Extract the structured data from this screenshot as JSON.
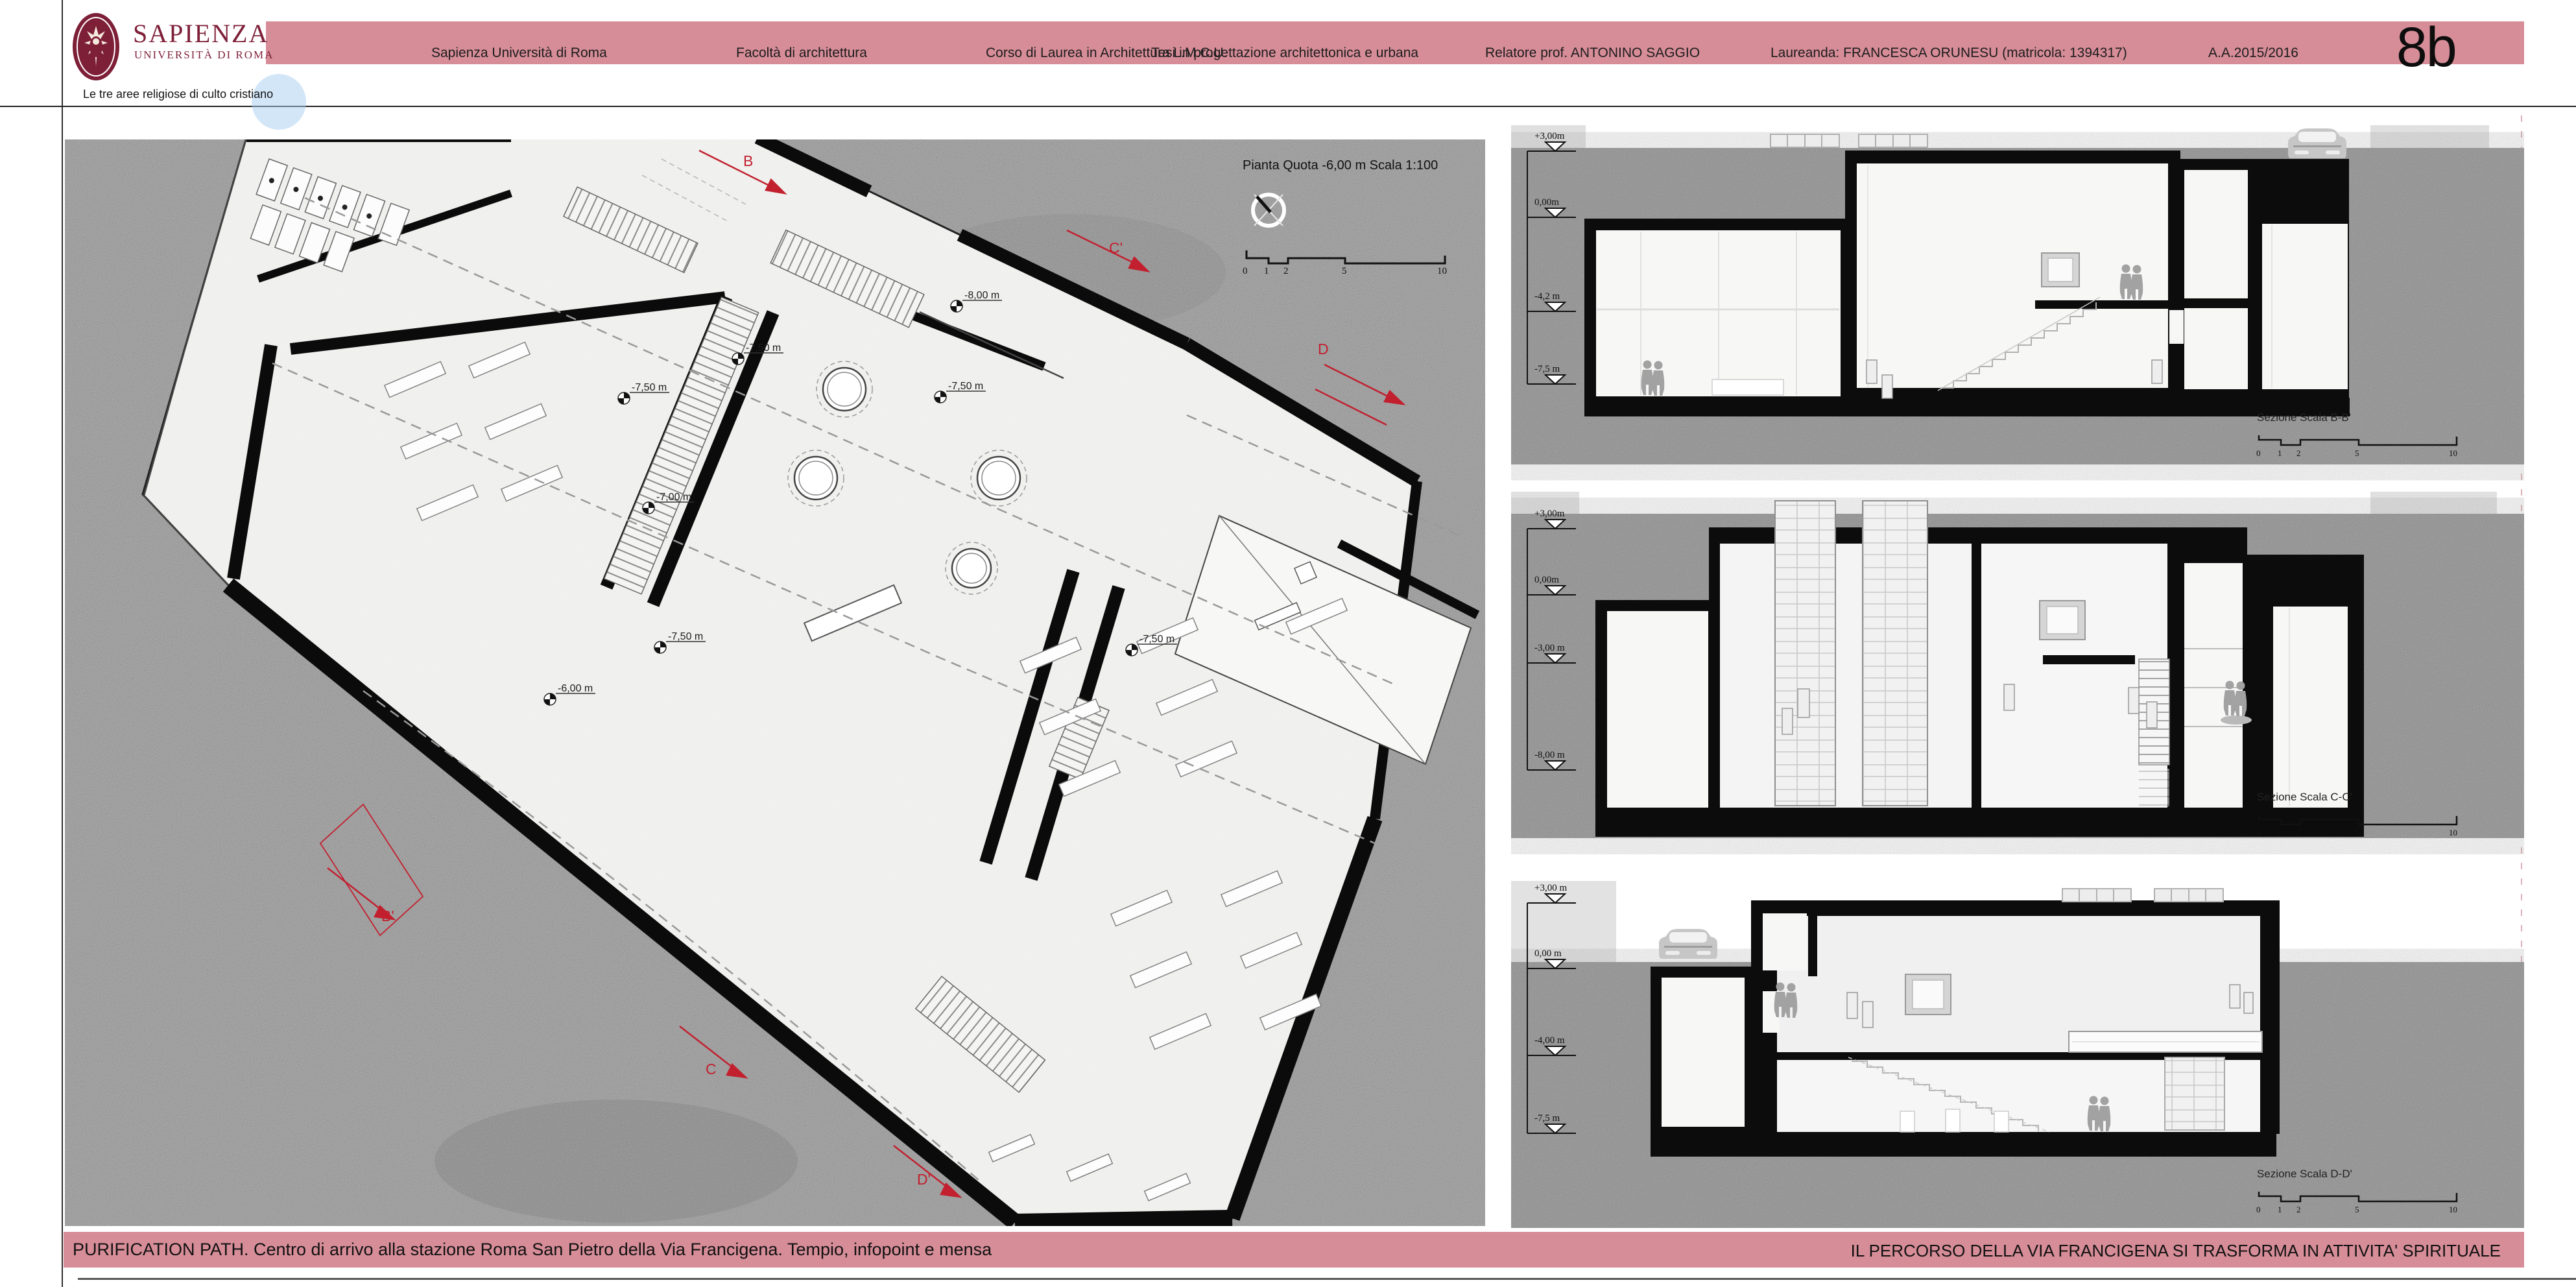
{
  "header": {
    "brand": {
      "name": "SAPIENZA",
      "subtitle": "UNIVERSITÀ DI ROMA"
    },
    "items": [
      {
        "label": "Sapienza Università di Roma"
      },
      {
        "label": "Facoltà di architettura"
      },
      {
        "label": "Corso di Laurea in Architettura L.M.C.U."
      },
      {
        "label": "Tesi in progettazione architettonica e urbana"
      },
      {
        "label": "Relatore prof. ANTONINO SAGGIO"
      },
      {
        "label": "Laureanda: FRANCESCA ORUNESU (matricola: 1394317)"
      },
      {
        "label": "A.A.2015/2016"
      }
    ],
    "page_number": "8b"
  },
  "subtitle": "Le tre aree religiose di culto cristiano",
  "plan": {
    "title": "Pianta Quota -6,00 m Scala 1:100",
    "levels": [
      "-8,00 m",
      "-7,50 m",
      "-7,50 m",
      "-7,50 m",
      "-7,00 m",
      "-7,50 m",
      "-7,50 m",
      "-6,00 m"
    ],
    "cuts": [
      "B",
      "C'",
      "D",
      "B'",
      "C",
      "D'"
    ]
  },
  "scalebar": {
    "ticks": [
      "0",
      "1",
      "2",
      "5",
      "10"
    ]
  },
  "sections": [
    {
      "label": "Sezione Scala B-B'",
      "elevations": [
        "+3,00m",
        "0,00m",
        "-4,2 m",
        "-7,5 m"
      ]
    },
    {
      "label": "Sezione Scala C-C'",
      "elevations": [
        "+3,00m",
        "0,00m",
        "-3,00 m",
        "-8,00 m"
      ]
    },
    {
      "label": "Sezione Scala D-D'",
      "elevations": [
        "+3,00 m",
        "0,00 m",
        "-4,00 m",
        "-7,5 m"
      ]
    }
  ],
  "footer": {
    "left": "PURIFICATION PATH. Centro di arrivo alla stazione Roma San Pietro della Via Francigena. Tempio, infopoint e mensa",
    "right": "IL PERCORSO DELLA VIA FRANCIGENA SI TRASFORMA IN ATTIVITA' SPIRITUALE"
  },
  "colors": {
    "pink": "#d68d98",
    "maroon": "#7e1f38",
    "cut_red": "#c2202f",
    "ground": "#929292",
    "sky": "#e0e0e0",
    "highlight_blue": "#aecdf0"
  }
}
